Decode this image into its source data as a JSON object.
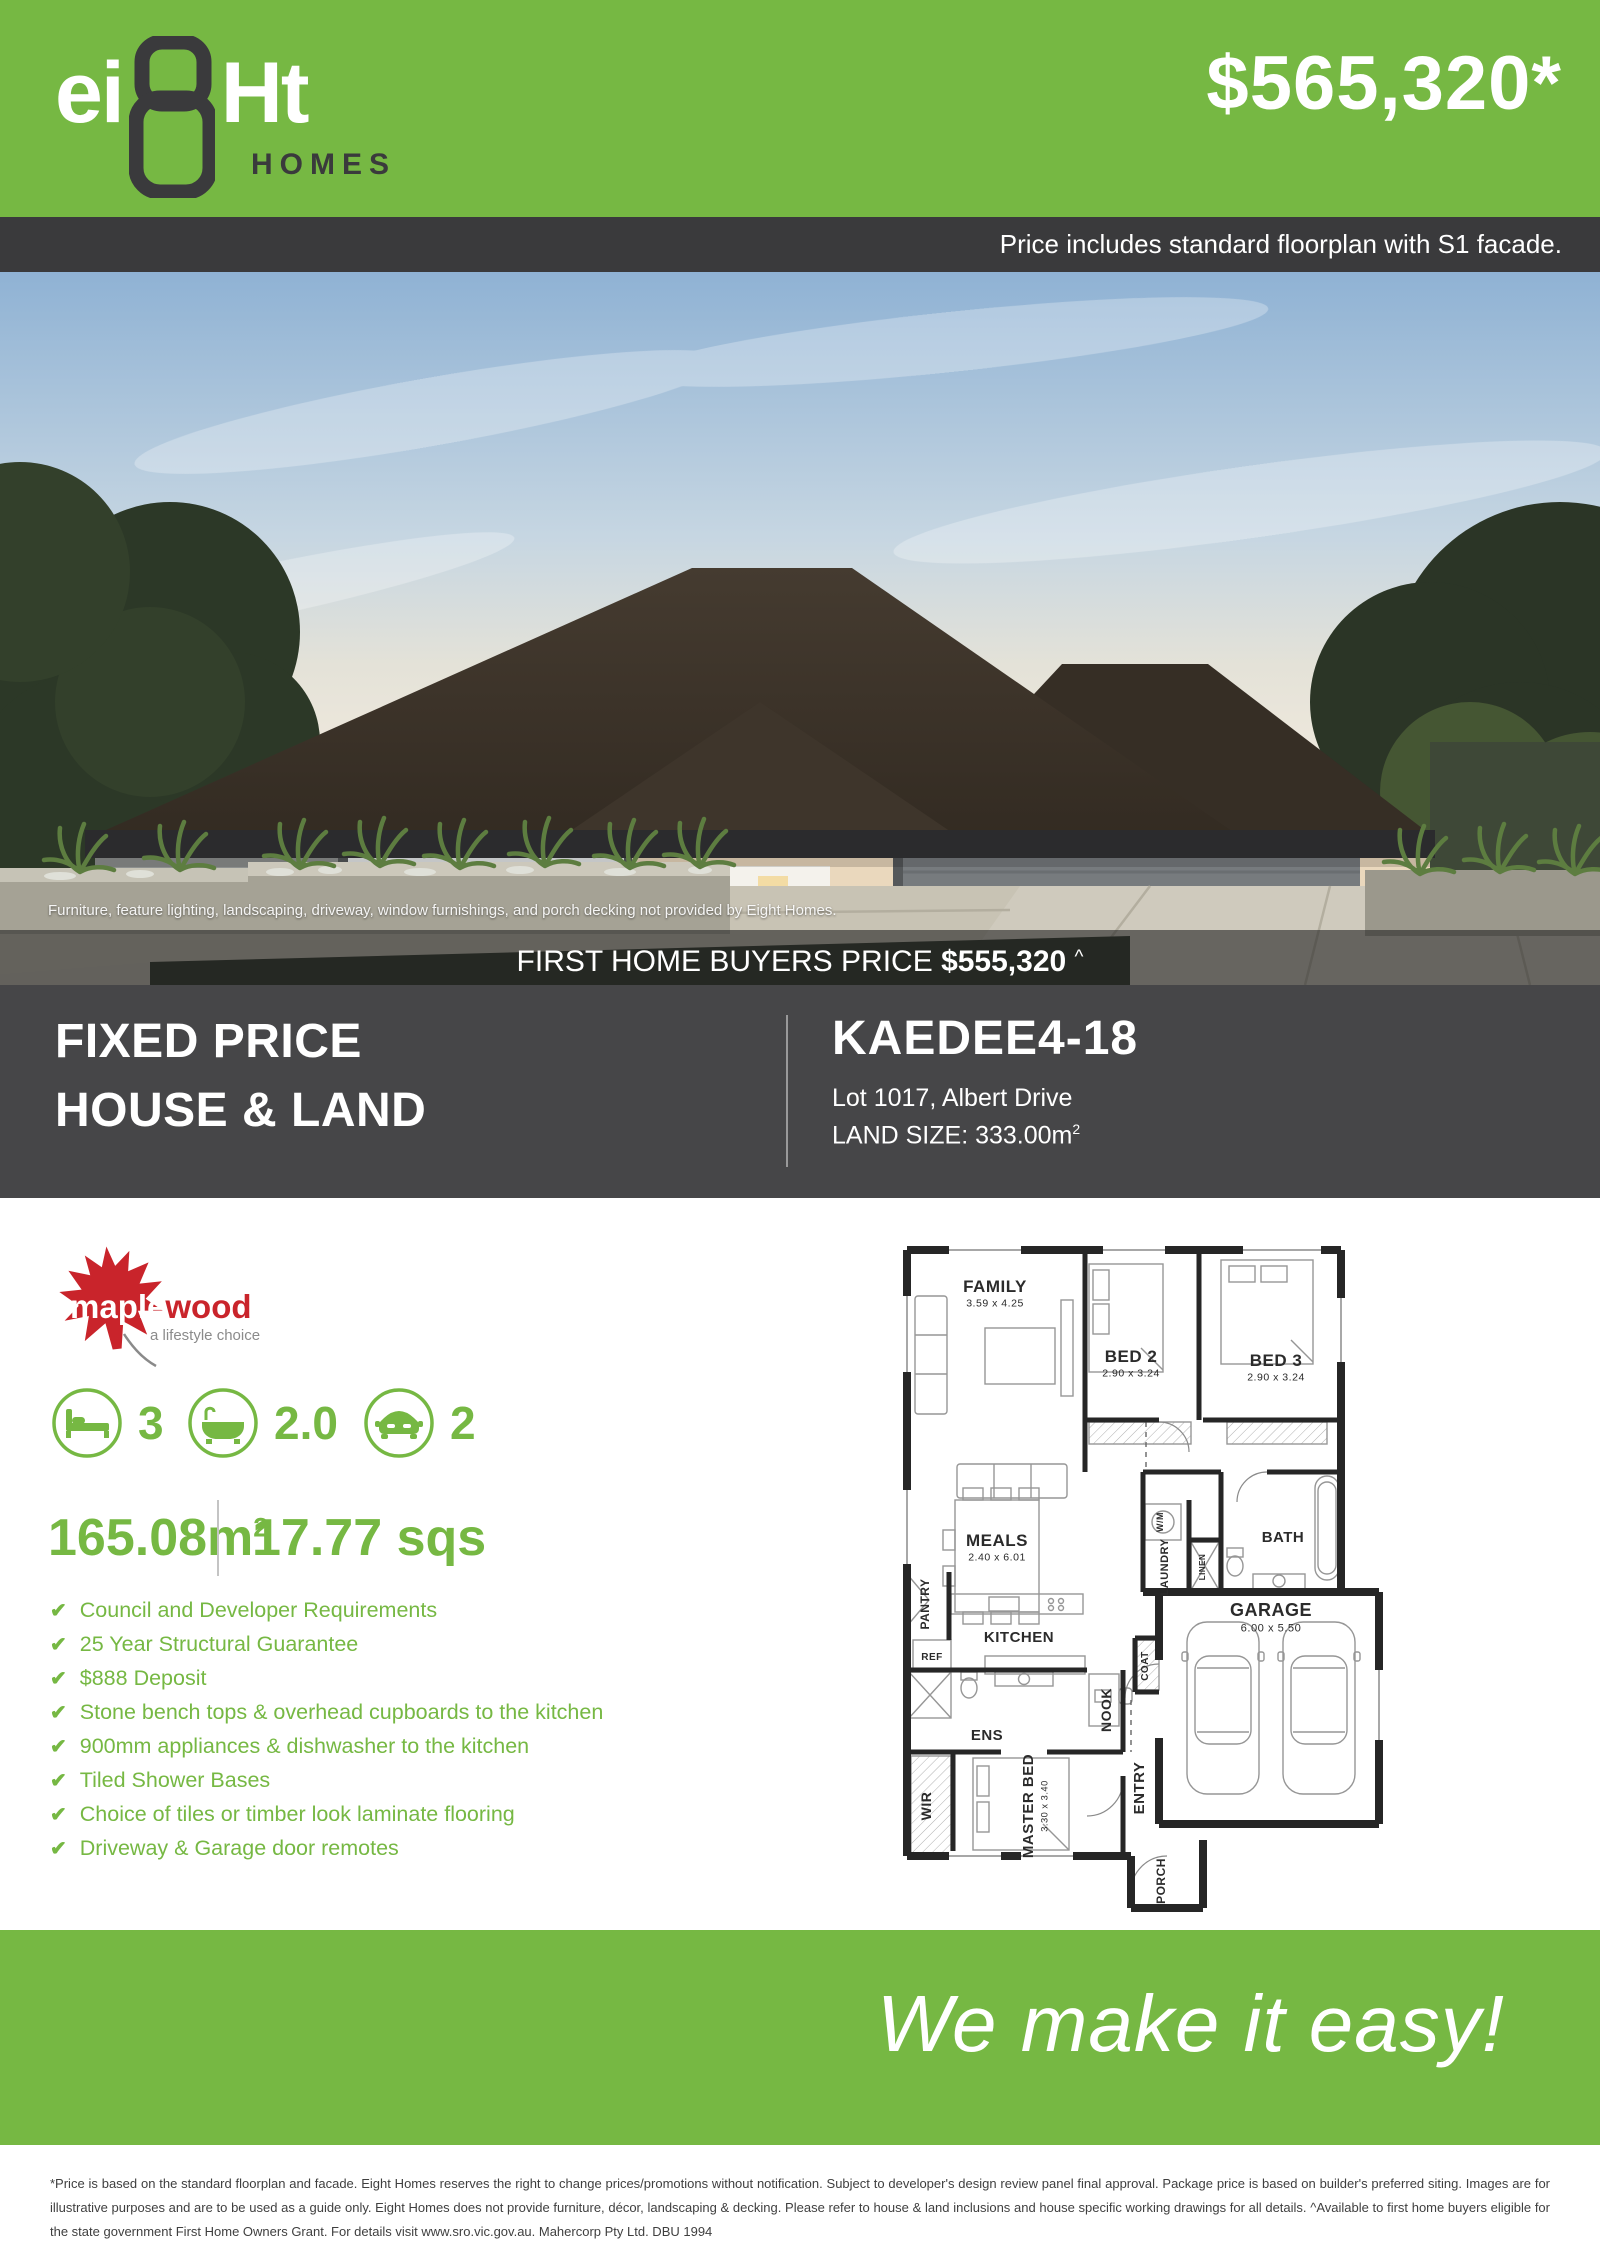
{
  "colors": {
    "green": "#76b843",
    "dark": "#3a3a3c",
    "section_dark": "#464648",
    "maple_red": "#c9242b"
  },
  "brand": {
    "logo_part1": "ei",
    "logo_eight": "8",
    "logo_part2": "Ht",
    "logo_homes": "HOMES"
  },
  "header": {
    "price": "$565,320*",
    "note": "Price includes standard floorplan with S1 facade."
  },
  "photo": {
    "caption": "Furniture, feature lighting, landscaping, driveway, window furnishings, and porch decking not provided by Eight Homes.",
    "fhb_label": "FIRST HOME BUYERS PRICE",
    "fhb_price": "$555,320",
    "fhb_sup": "^"
  },
  "package": {
    "title_line1": "FIXED PRICE",
    "title_line2": "HOUSE & LAND",
    "plan_name": "KAEDEE4-18",
    "lot": "Lot 1017, Albert Drive",
    "land_size_base": "LAND SIZE: 333.00m",
    "land_size_sup": "2"
  },
  "estate": {
    "name_part1": "maple",
    "name_part2": "wood",
    "tagline": "a lifestyle choice"
  },
  "specs": {
    "beds": "3",
    "baths": "2.0",
    "cars": "2",
    "area_base": "165.08m",
    "area_sup": "2",
    "area_sqs": "17.77 sqs"
  },
  "icons": {
    "check": "✔"
  },
  "inclusions": [
    "Council and Developer Requirements",
    "25 Year Structural Guarantee",
    "$888 Deposit",
    "Stone bench tops & overhead cupboards to the kitchen",
    "900mm appliances & dishwasher to the kitchen",
    "Tiled Shower Bases",
    "Choice of tiles or timber look laminate flooring",
    "Driveway & Garage door remotes"
  ],
  "floorplan": {
    "rooms": [
      {
        "label": "FAMILY",
        "dims": "3.59 x 4.25",
        "x": 104,
        "y": 52,
        "rot": 0,
        "fs": 17
      },
      {
        "label": "BED 2",
        "dims": "2.90 x 3.24",
        "x": 240,
        "y": 122,
        "rot": 0,
        "fs": 17
      },
      {
        "label": "BED 3",
        "dims": "2.90 x 3.24",
        "x": 385,
        "y": 126,
        "rot": 0,
        "fs": 17
      },
      {
        "label": "MEALS",
        "dims": "2.40 x 6.01",
        "x": 106,
        "y": 306,
        "rot": 0,
        "fs": 17
      },
      {
        "label": "GARAGE",
        "dims": "6.00 x 5.50",
        "x": 380,
        "y": 376,
        "rot": 0,
        "fs": 18
      },
      {
        "label": "KITCHEN",
        "x": 128,
        "y": 402,
        "rot": 0,
        "fs": 15
      },
      {
        "label": "BATH",
        "x": 392,
        "y": 302,
        "rot": 0,
        "fs": 15
      },
      {
        "label": "ENS",
        "x": 96,
        "y": 500,
        "rot": 0,
        "fs": 15
      },
      {
        "label": "REF",
        "x": 41,
        "y": 420,
        "rot": 0,
        "fs": 10
      },
      {
        "label": "W/M",
        "x": 272,
        "y": 282,
        "rot": -90,
        "fs": 9
      },
      {
        "label": "LAUNDRY",
        "x": 277,
        "y": 327,
        "rot": -90,
        "fs": 11
      },
      {
        "label": "LINEN",
        "x": 314,
        "y": 327,
        "rot": -90,
        "fs": 8
      },
      {
        "label": "PANTRY",
        "x": 38,
        "y": 364,
        "rot": -90,
        "fs": 12
      },
      {
        "label": "COAT",
        "x": 257,
        "y": 426,
        "rot": -90,
        "fs": 10
      },
      {
        "label": "NOOK",
        "x": 220,
        "y": 470,
        "rot": -90,
        "fs": 14
      },
      {
        "label": "ENTRY",
        "x": 253,
        "y": 548,
        "rot": -90,
        "fs": 15
      },
      {
        "label": "WIR",
        "x": 40,
        "y": 566,
        "rot": -90,
        "fs": 14
      },
      {
        "label": "MASTER BED",
        "dims": "3.30 x 3.40",
        "x": 142,
        "y": 566,
        "rot": -90,
        "fs": 15
      },
      {
        "label": "PORCH",
        "x": 274,
        "y": 641,
        "rot": -90,
        "fs": 12
      }
    ]
  },
  "footer": {
    "slogan": "We make it easy!"
  },
  "fineprint": "*Price is based on the standard floorplan and facade. Eight Homes reserves the right to change prices/promotions without notification. Subject to developer's design review panel final approval. Package price is based on builder's preferred siting. Images are for illustrative purposes and are to be used as a guide only. Eight Homes does not provide furniture, décor, landscaping & decking. Please refer to house & land inclusions and house specific working drawings for all details. ^Available to first home buyers eligible for the state government First Home Owners Grant. For details visit www.sro.vic.gov.au. Mahercorp Pty Ltd. DBU 1994"
}
